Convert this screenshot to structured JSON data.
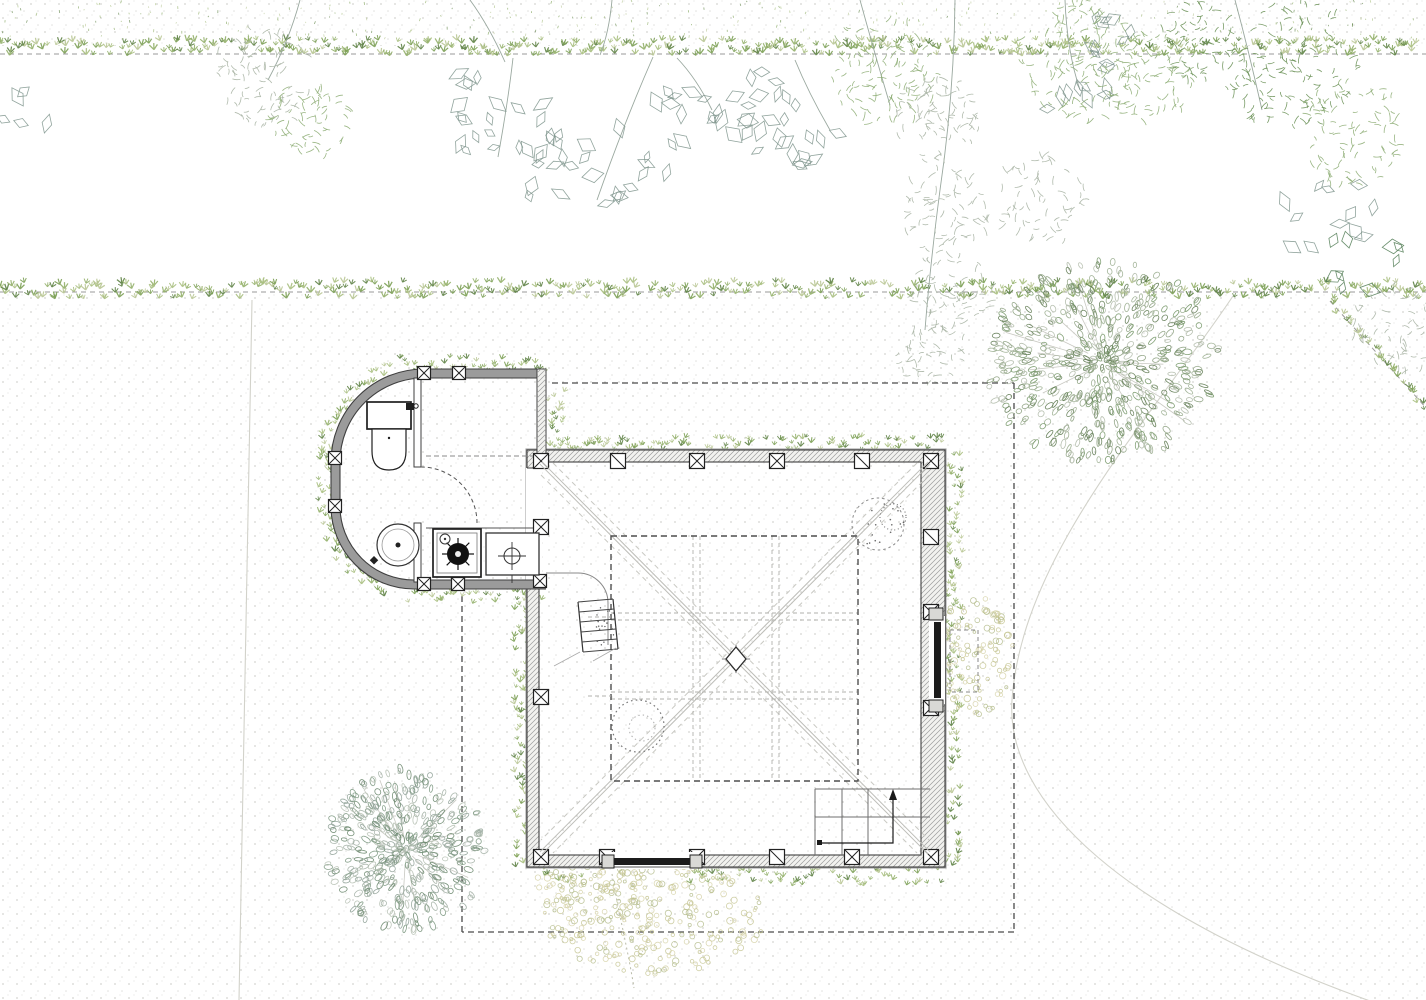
{
  "meta": {
    "width": 1426,
    "height": 1000,
    "background": "#ffffff",
    "drawing_type": "architectural-site-plan-ground-floor"
  },
  "palette": {
    "wall_edge": "#3f3f3f",
    "wall_fill": "#f2f2ef",
    "wall_band": "#9b9b9b",
    "hatch": "#9c9c9c",
    "dash_dark": "#4a4a4a",
    "grid_dash": "#b2b2ad",
    "ridge": "#bdbdb8",
    "ridge_dash": "#c9c9c3",
    "faint": "#d2d2ca",
    "fixture": "#1f1f1f",
    "dot": "#8e8e86",
    "boundary_line": "#9a9a98",
    "hedge": [
      "#7ca055",
      "#93b06a",
      "#a9bf80",
      "#5e8245",
      "#b9c795"
    ],
    "leaf_gray": "#7e948c",
    "leaf_green_dark": "#4f7a52",
    "fern_green": "#8fae77",
    "fern_gray": "#a9b4a4",
    "fern_dark": "#6d9259",
    "branch": "#9aa89f",
    "tree_ne": [
      "#8fa383",
      "#9db092",
      "#7a9a6d",
      "#b2bcaa",
      "#657f58"
    ],
    "tree_sw": [
      "#93a49a",
      "#a6b3a8",
      "#7f9a83",
      "#b7c1b4",
      "#6e8a70"
    ],
    "gravel": [
      "#c6c593",
      "#b5bd8d",
      "#d6d2a8"
    ]
  },
  "ground": {
    "dot_bands": [
      [
        0,
        0,
        1426,
        46
      ],
      [
        0,
        294,
        1426,
        706
      ]
    ]
  },
  "boundaries": {
    "top_hedge_line_y": 54,
    "mid_hedge_line_y": 292,
    "top_strip": [
      0,
      40,
      1426,
      16
    ],
    "mid_strip": [
      0,
      282,
      1426,
      17
    ],
    "speckle_band": [
      0,
      2,
      1426,
      38
    ],
    "diag_line": [
      1330,
      301,
      1428,
      410
    ],
    "faint_paths": [
      "M252,300 C249,480 243,720 239,1000",
      "M1233,296 C1150,420 1022,555 1012,700 C1005,800 1120,915 1390,1008"
    ],
    "dotted_trail": "M612,874 C618,910 628,950 634,988"
  },
  "canopy": {
    "branches": [
      [
        513,
        58,
        498,
        157
      ],
      [
        653,
        57,
        597,
        200
      ],
      [
        677,
        58,
        712,
        110
      ],
      [
        470,
        0,
        505,
        62
      ],
      [
        860,
        0,
        890,
        105
      ],
      [
        955,
        0,
        940,
        190
      ],
      [
        940,
        190,
        925,
        330
      ],
      [
        1065,
        0,
        1080,
        90
      ],
      [
        1235,
        0,
        1262,
        110
      ],
      [
        795,
        60,
        830,
        130
      ],
      [
        300,
        0,
        268,
        80
      ],
      [
        612,
        0,
        600,
        55
      ]
    ],
    "rhombus_clusters": [
      {
        "cx": 505,
        "cy": 135,
        "r": 55,
        "n": 15
      },
      {
        "cx": 545,
        "cy": 172,
        "r": 42,
        "n": 10
      },
      {
        "cx": 480,
        "cy": 95,
        "r": 35,
        "n": 7
      },
      {
        "cx": 620,
        "cy": 165,
        "r": 52,
        "n": 13
      },
      {
        "cx": 680,
        "cy": 120,
        "r": 45,
        "n": 11
      },
      {
        "cx": 760,
        "cy": 120,
        "r": 50,
        "n": 12
      },
      {
        "cx": 765,
        "cy": 95,
        "r": 38,
        "n": 8
      },
      {
        "cx": 805,
        "cy": 145,
        "r": 38,
        "n": 9
      },
      {
        "cx": 1075,
        "cy": 82,
        "r": 48,
        "n": 12
      },
      {
        "cx": 1108,
        "cy": 40,
        "r": 33,
        "n": 7
      },
      {
        "cx": 1325,
        "cy": 215,
        "r": 52,
        "n": 12
      },
      {
        "cx": 30,
        "cy": 112,
        "r": 30,
        "n": 5
      }
    ],
    "rhombus_dark_clusters": [
      {
        "cx": 1368,
        "cy": 262,
        "r": 48,
        "n": 9
      }
    ],
    "fern_clusters": [
      {
        "cx": 262,
        "cy": 78,
        "r": 50,
        "n": 90,
        "c": "fern_gray"
      },
      {
        "cx": 310,
        "cy": 118,
        "r": 40,
        "n": 60,
        "c": "fern_green"
      },
      {
        "cx": 885,
        "cy": 70,
        "r": 55,
        "n": 110,
        "c": "fern_green"
      },
      {
        "cx": 938,
        "cy": 120,
        "r": 45,
        "n": 80,
        "c": "fern_gray"
      },
      {
        "cx": 1080,
        "cy": 60,
        "r": 60,
        "n": 130,
        "c": "fern_green"
      },
      {
        "cx": 1148,
        "cy": 78,
        "r": 45,
        "n": 80,
        "c": "fern_green"
      },
      {
        "cx": 1195,
        "cy": 40,
        "r": 40,
        "n": 60,
        "c": "fern_dark"
      },
      {
        "cx": 945,
        "cy": 215,
        "r": 45,
        "n": 70,
        "c": "fern_gray"
      },
      {
        "cx": 952,
        "cy": 290,
        "r": 40,
        "n": 58,
        "c": "fern_gray"
      },
      {
        "cx": 932,
        "cy": 352,
        "r": 34,
        "n": 46,
        "c": "fern_gray"
      },
      {
        "cx": 1042,
        "cy": 200,
        "r": 45,
        "n": 64,
        "c": "fern_gray"
      },
      {
        "cx": 1290,
        "cy": 66,
        "r": 68,
        "n": 140,
        "c": "fern_dark"
      },
      {
        "cx": 1352,
        "cy": 132,
        "r": 55,
        "n": 92,
        "c": "fern_green"
      },
      {
        "cx": 1396,
        "cy": 330,
        "r": 45,
        "n": 56,
        "c": "fern_gray"
      }
    ]
  },
  "trees": [
    {
      "name": "round-tree-northeast",
      "cx": 1103,
      "cy": 362,
      "rx": 118,
      "ry": 102,
      "n": 560,
      "palette": "tree_ne",
      "branches": 12
    },
    {
      "name": "round-tree-southwest",
      "cx": 406,
      "cy": 850,
      "rx": 80,
      "ry": 82,
      "n": 430,
      "palette": "tree_sw",
      "branches": 10
    }
  ],
  "roof_outline": [
    "M552,383 H1014",
    "M1014,383 V932",
    "M1014,932 H462",
    "M462,932 V592"
  ],
  "building": {
    "main_room": {
      "outer": [
        527,
        450,
        418,
        417
      ],
      "inner": [
        539,
        462,
        382,
        393
      ],
      "row_top_y": 461,
      "row_bottom_y": 857,
      "col_left_x": 541,
      "col_right_x": 931,
      "box": 15,
      "columns_x_top": [
        541,
        618,
        697,
        777,
        862,
        931
      ],
      "marks_top": [
        "x",
        "s",
        "x",
        "x",
        "s",
        "x"
      ],
      "columns_x_bottom": [
        541,
        607,
        697,
        777,
        852,
        931
      ],
      "marks_bottom": [
        "x",
        "x",
        "x",
        "s",
        "x",
        "x"
      ],
      "columns_left_y": [
        527,
        697
      ],
      "columns_right_y": [
        537,
        612,
        708
      ],
      "marks_right": [
        "s",
        "x",
        "x"
      ]
    },
    "south_door": {
      "opening": [
        606,
        852,
        92,
        17
      ],
      "bar": [
        614,
        858,
        76,
        7
      ],
      "caps": [
        [
          602,
          855,
          12,
          13
        ],
        [
          690,
          855,
          12,
          13
        ]
      ],
      "track": [
        614,
        867,
        690,
        867
      ]
    },
    "east_window": {
      "opening": [
        929,
        616,
        16,
        88
      ],
      "bar": [
        934,
        622,
        7,
        76
      ],
      "caps": [
        [
          929,
          608,
          14,
          12
        ],
        [
          929,
          700,
          14,
          12
        ]
      ],
      "dashed_rect": [
        950,
        630,
        28,
        62
      ]
    },
    "west_passage": [
      526,
      468,
      16,
      112
    ],
    "annex": {
      "outer": "M546,369 H424 A93,93 0 0 0 331,462 V506 A83,83 0 0 0 414,589 H546",
      "inner": "M546,378 H425 A84,84 0 0 0 340,462 V505 A74,74 0 0 0 415,580 H546",
      "mid": "M546,373.5 H424.5 A88.5,88.5 0 0 0 335.5,462 V505.5 A78.5,78.5 0 0 0 414.5,584.5 H546",
      "right_wall": [
        537,
        369,
        9,
        99
      ],
      "columns": [
        [
          424,
          373
        ],
        [
          459,
          373
        ],
        [
          335,
          458
        ],
        [
          335,
          506
        ],
        [
          424,
          584
        ],
        [
          458,
          584
        ],
        [
          540,
          581
        ]
      ],
      "partition": [
        [
          414,
          378,
          7,
          89
        ],
        [
          414,
          523,
          7,
          59
        ]
      ],
      "door_arc": "M477,523 A56,56 0 0 0 421,467",
      "ceiling_dash": [
        426,
        456,
        543,
        456
      ],
      "counter_edge": [
        426,
        528,
        540,
        528
      ]
    },
    "fixtures": {
      "toilet": {
        "tank": [
          367,
          402,
          44,
          27
        ],
        "bowl": "M372,429 V451 Q372,470 389,470 Q406,470 406,451 V429 Z",
        "dot": [
          389,
          438
        ],
        "valve": [
          406,
          403,
          8,
          7
        ]
      },
      "basin": {
        "cx": 398,
        "cy": 545,
        "r": 21,
        "r2": 16,
        "tap": [
          374,
          556,
          6,
          6
        ]
      },
      "stove": {
        "outer": [
          433,
          529,
          48,
          48
        ],
        "inner": [
          437,
          533,
          40,
          40
        ],
        "burner": [
          458,
          554,
          11
        ],
        "spokes": 8,
        "small": [
          445,
          539,
          5
        ]
      },
      "sink": {
        "rect": [
          486,
          533,
          53,
          42
        ],
        "drain": [
          512,
          556,
          8
        ],
        "cross": 14
      }
    },
    "interior": {
      "ridges": [
        [
          541,
          463,
          929,
          853
        ],
        [
          929,
          463,
          541,
          853
        ]
      ],
      "ridge_dashes": [
        "M553,463 L929,840",
        "M541,475 L917,853",
        "M917,463 L541,840",
        "M929,475 L553,853"
      ],
      "inner_square": [
        611,
        536,
        247,
        245
      ],
      "grid_v": [
        693,
        700,
        772,
        779
      ],
      "grid_h": [
        613,
        620,
        692,
        699
      ],
      "stubs": [
        [
          588,
          617,
          611,
          617
        ],
        [
          588,
          696,
          611,
          696
        ]
      ],
      "center": [
        736,
        659
      ],
      "fillet": "M546,573 H578 A30,30 0 0 1 608,603 V645",
      "ladder": {
        "x": 578,
        "y": 602,
        "w": 35,
        "h": 50,
        "rungs": 5
      },
      "stairs": {
        "x1": 815,
        "y1": 789,
        "x2": 930,
        "y2": 855,
        "h_lines": [
          789,
          817
        ],
        "v_lines": [
          815,
          842,
          868
        ],
        "arrow": "M820,843 H893 V797",
        "head": [
          [
            889,
            800
          ],
          [
            897,
            800
          ],
          [
            893,
            789
          ]
        ]
      },
      "tree_blob": {
        "cx": 878,
        "cy": 524,
        "r": 26,
        "ring": [
          893,
          517,
          13
        ]
      },
      "hearth": {
        "cx": 638,
        "cy": 726,
        "r": 26,
        "r2": 13
      }
    }
  },
  "perimeter_hedges": {
    "rects": [
      {
        "r": [
          398,
          357,
          148,
          15
        ],
        "d": 0.85
      },
      {
        "r": [
          318,
          450,
          15,
          62
        ],
        "d": 0.85
      },
      {
        "r": [
          408,
          589,
          138,
          15
        ],
        "d": 0.85
      },
      {
        "r": [
          548,
          437,
          392,
          14
        ],
        "d": 0.8
      },
      {
        "r": [
          946,
          455,
          16,
          412
        ],
        "d": 0.8
      },
      {
        "r": [
          688,
          869,
          256,
          17
        ],
        "d": 0.8
      },
      {
        "r": [
          514,
          595,
          16,
          272
        ],
        "d": 0.75
      },
      {
        "r": [
          548,
          390,
          16,
          55
        ],
        "d": 0.8
      },
      {
        "r": [
          534,
          869,
          70,
          14
        ],
        "d": 0.3
      }
    ],
    "arcs": [
      {
        "cx": 424,
        "cy": 462,
        "r": 100,
        "a0": 180,
        "a1": 252
      },
      {
        "cx": 414,
        "cy": 505,
        "r": 90,
        "a0": 108,
        "a1": 180
      }
    ]
  },
  "gravel_patches": [
    {
      "cx": 655,
      "cy": 916,
      "rx": 112,
      "ry": 58,
      "n": 260
    },
    {
      "cx": 974,
      "cy": 656,
      "rx": 40,
      "ry": 60,
      "n": 120
    },
    {
      "cx": 590,
      "cy": 886,
      "rx": 55,
      "ry": 26,
      "n": 60
    }
  ]
}
